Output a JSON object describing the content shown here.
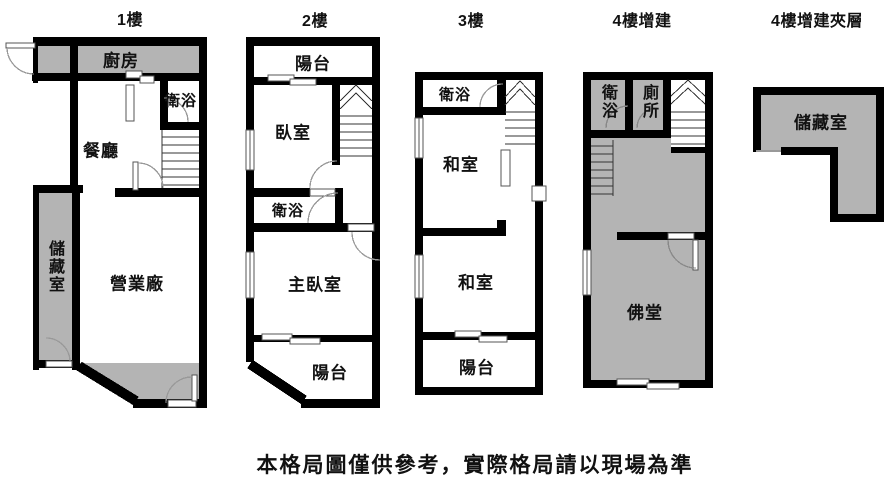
{
  "floors": [
    {
      "title": "1樓",
      "rooms": {
        "kitchen": "廚房",
        "bathroom": "衛浴",
        "dining": "餐廳",
        "storage": "儲藏室",
        "business": "營業廠"
      }
    },
    {
      "title": "2樓",
      "rooms": {
        "balcony_front": "陽台",
        "bedroom": "臥室",
        "bathroom": "衛浴",
        "master_bedroom": "主臥室",
        "balcony_rear": "陽台"
      }
    },
    {
      "title": "3樓",
      "rooms": {
        "bathroom": "衛浴",
        "tatami_upper": "和室",
        "tatami_lower": "和室",
        "balcony": "陽台"
      }
    },
    {
      "title": "4樓增建",
      "rooms": {
        "bathroom": "衛浴",
        "toilet": "廁所",
        "buddhist_hall": "佛堂"
      }
    },
    {
      "title": "4樓增建夾層",
      "rooms": {
        "storage": "儲藏室"
      }
    }
  ],
  "caption": "本格局圖僅供參考，實際格局請以現場為準",
  "colors": {
    "wall": "#000000",
    "room_fill": "#b4b4b4",
    "background": "#ffffff"
  }
}
